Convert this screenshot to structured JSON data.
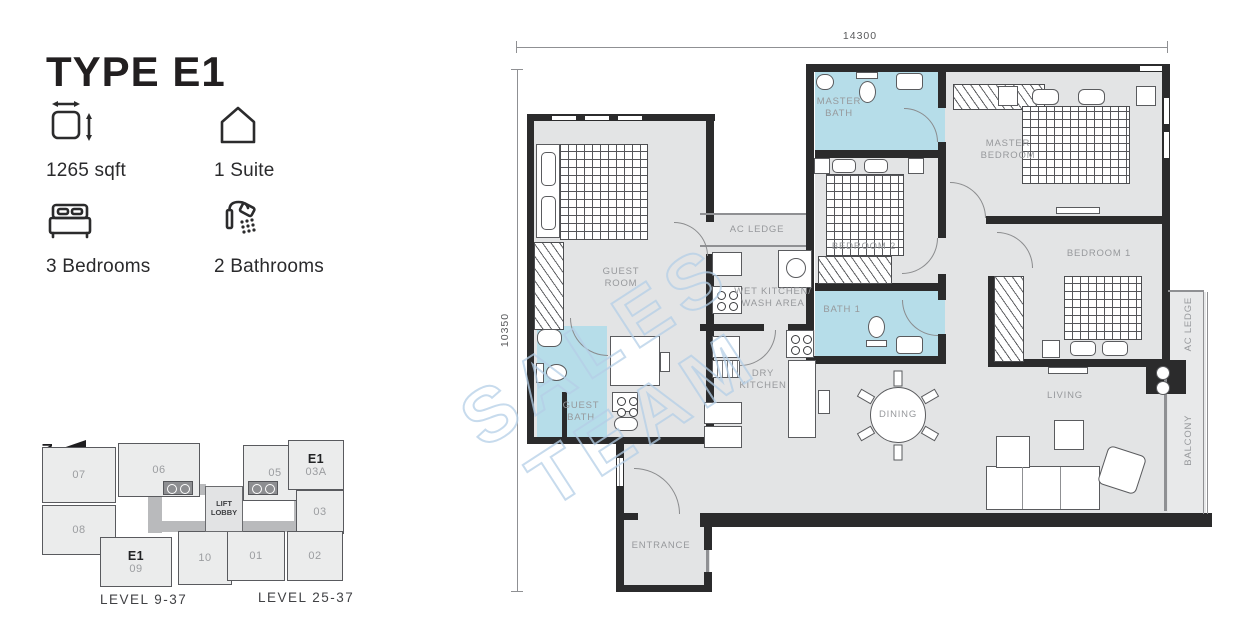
{
  "unit": {
    "title": "TYPE E1"
  },
  "specs": [
    {
      "icon": "area-icon",
      "label": "1265 sqft"
    },
    {
      "icon": "house-icon",
      "label": "1 Suite"
    },
    {
      "icon": "bed-icon",
      "label": "3 Bedrooms"
    },
    {
      "icon": "shower-icon",
      "label": "2 Bathrooms"
    }
  ],
  "floor_plan": {
    "dimension_width": "14300",
    "dimension_height": "10350",
    "watermark": "SALES TEAM",
    "rooms": {
      "master_bath": "MASTER\nBATH",
      "master_bedroom": "MASTER\nBEDROOM",
      "bedroom_2": "BEDROOM 2",
      "bedroom_1": "BEDROOM 1",
      "guest_room": "GUEST\nROOM",
      "guest_bath": "GUEST\nBATH",
      "bath_1": "BATH 1",
      "ac_ledge_top": "AC LEDGE",
      "ac_ledge_right": "AC LEDGE",
      "wet_kitchen": "WET KITCHEN/\nWASH AREA",
      "dry_kitchen": "DRY\nKITCHEN",
      "dining": "DINING",
      "living": "LIVING",
      "balcony": "BALCONY",
      "entrance": "ENTRANCE"
    }
  },
  "key_plan": {
    "north": "N",
    "lift_lobby": "LIFT\nLOBBY",
    "levels": [
      "LEVEL 9-37",
      "LEVEL 25-37"
    ],
    "units": [
      {
        "number": "07"
      },
      {
        "number": "06"
      },
      {
        "number": "05"
      },
      {
        "number": "03A",
        "type": "E1"
      },
      {
        "number": "03"
      },
      {
        "number": "08"
      },
      {
        "number": "09",
        "type": "E1"
      },
      {
        "number": "10"
      },
      {
        "number": "01"
      },
      {
        "number": "02"
      }
    ]
  },
  "colors": {
    "wall": "#2b2b2c",
    "room_fill": "#e3e4e5",
    "bath_fill": "#b6dde9",
    "label": "#97999c",
    "watermark_stroke": "#b5cfe7"
  }
}
